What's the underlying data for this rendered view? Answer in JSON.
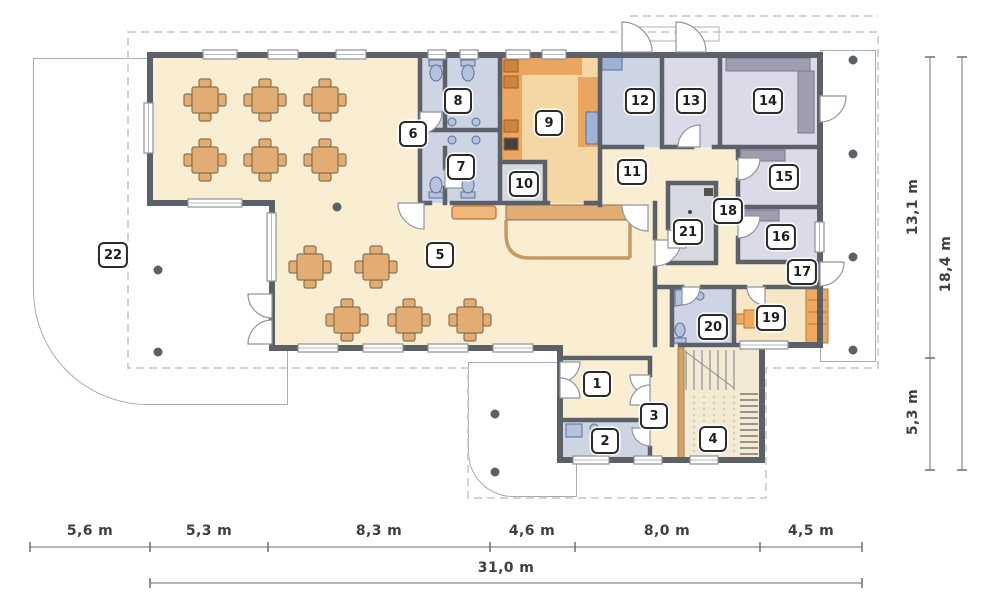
{
  "plan_title": "ground floor plan",
  "rooms": [
    {
      "num": "1"
    },
    {
      "num": "2"
    },
    {
      "num": "3"
    },
    {
      "num": "4"
    },
    {
      "num": "5"
    },
    {
      "num": "6"
    },
    {
      "num": "7"
    },
    {
      "num": "8"
    },
    {
      "num": "9"
    },
    {
      "num": "10"
    },
    {
      "num": "11"
    },
    {
      "num": "12"
    },
    {
      "num": "13"
    },
    {
      "num": "14"
    },
    {
      "num": "15"
    },
    {
      "num": "16"
    },
    {
      "num": "17"
    },
    {
      "num": "18"
    },
    {
      "num": "19"
    },
    {
      "num": "20"
    },
    {
      "num": "21"
    },
    {
      "num": "22"
    }
  ],
  "dimensions": {
    "bottom_segments": [
      {
        "label": "5,6 m"
      },
      {
        "label": "5,3 m"
      },
      {
        "label": "8,3 m"
      },
      {
        "label": "4,6 m"
      },
      {
        "label": "8,0 m"
      },
      {
        "label": "4,5 m"
      }
    ],
    "bottom_total": "31,0 m",
    "right_upper": "13,1 m",
    "right_lower": "5,3 m",
    "right_total": "18,4 m"
  },
  "colors": {
    "wall": "#5c6169",
    "floor_main": "#f9edd2",
    "floor_bath": "#cdd5e4",
    "floor_suite": "#dcd9e8",
    "floor_utility": "#d6d9e0",
    "floor_kitchen": "#f5d7a6",
    "counter_wood": "#eaa55e",
    "furniture_wood": "#e3ac72",
    "fixture_blue": "#b6c3de",
    "dash_outline": "#c3c7cc",
    "dim_line": "#6b7076"
  }
}
